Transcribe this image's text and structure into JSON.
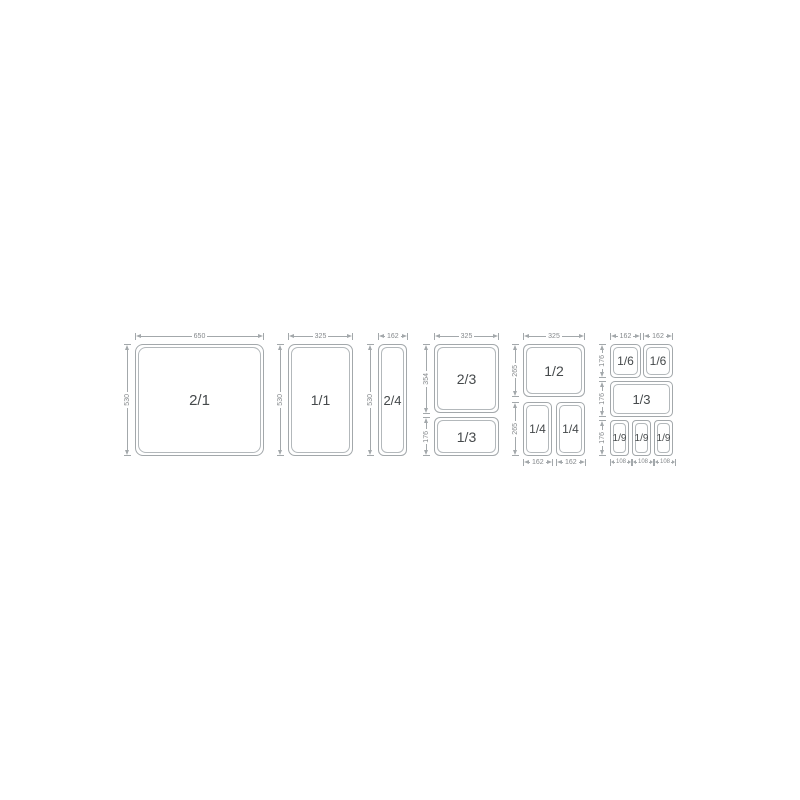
{
  "colors": {
    "line": "#a3a8ab",
    "line_inner": "#b3b8bb",
    "dim_text": "#85898c",
    "label_text": "#45494b"
  },
  "groups": [
    {
      "name": "GN 2/1",
      "pans": [
        "2/1"
      ],
      "top": [
        "650"
      ],
      "left": [
        "530"
      ],
      "bottom": []
    },
    {
      "name": "GN 1/1",
      "pans": [
        "1/1"
      ],
      "top": [
        "325"
      ],
      "left": [
        "530"
      ],
      "bottom": []
    },
    {
      "name": "GN 2/4",
      "pans": [
        "2/4"
      ],
      "top": [
        "162"
      ],
      "left": [
        "530"
      ],
      "bottom": []
    },
    {
      "name": "GN 2/3 + 1/3",
      "pans": [
        "2/3",
        "1/3"
      ],
      "top": [
        "325"
      ],
      "left": [
        "354",
        "176"
      ],
      "bottom": []
    },
    {
      "name": "GN 1/2 + 1/4",
      "pans": [
        "1/2",
        "1/4",
        "1/4"
      ],
      "top": [
        "325"
      ],
      "left": [
        "265",
        "265"
      ],
      "bottom": [
        "162",
        "162"
      ]
    },
    {
      "name": "GN 1/6 + 1/3 + 1/9",
      "pans": [
        "1/6",
        "1/6",
        "1/3",
        "1/9",
        "1/9",
        "1/9"
      ],
      "top": [
        "162",
        "162"
      ],
      "left": [
        "176",
        "176",
        "176"
      ],
      "bottom": [
        "108",
        "108",
        "108"
      ]
    }
  ]
}
